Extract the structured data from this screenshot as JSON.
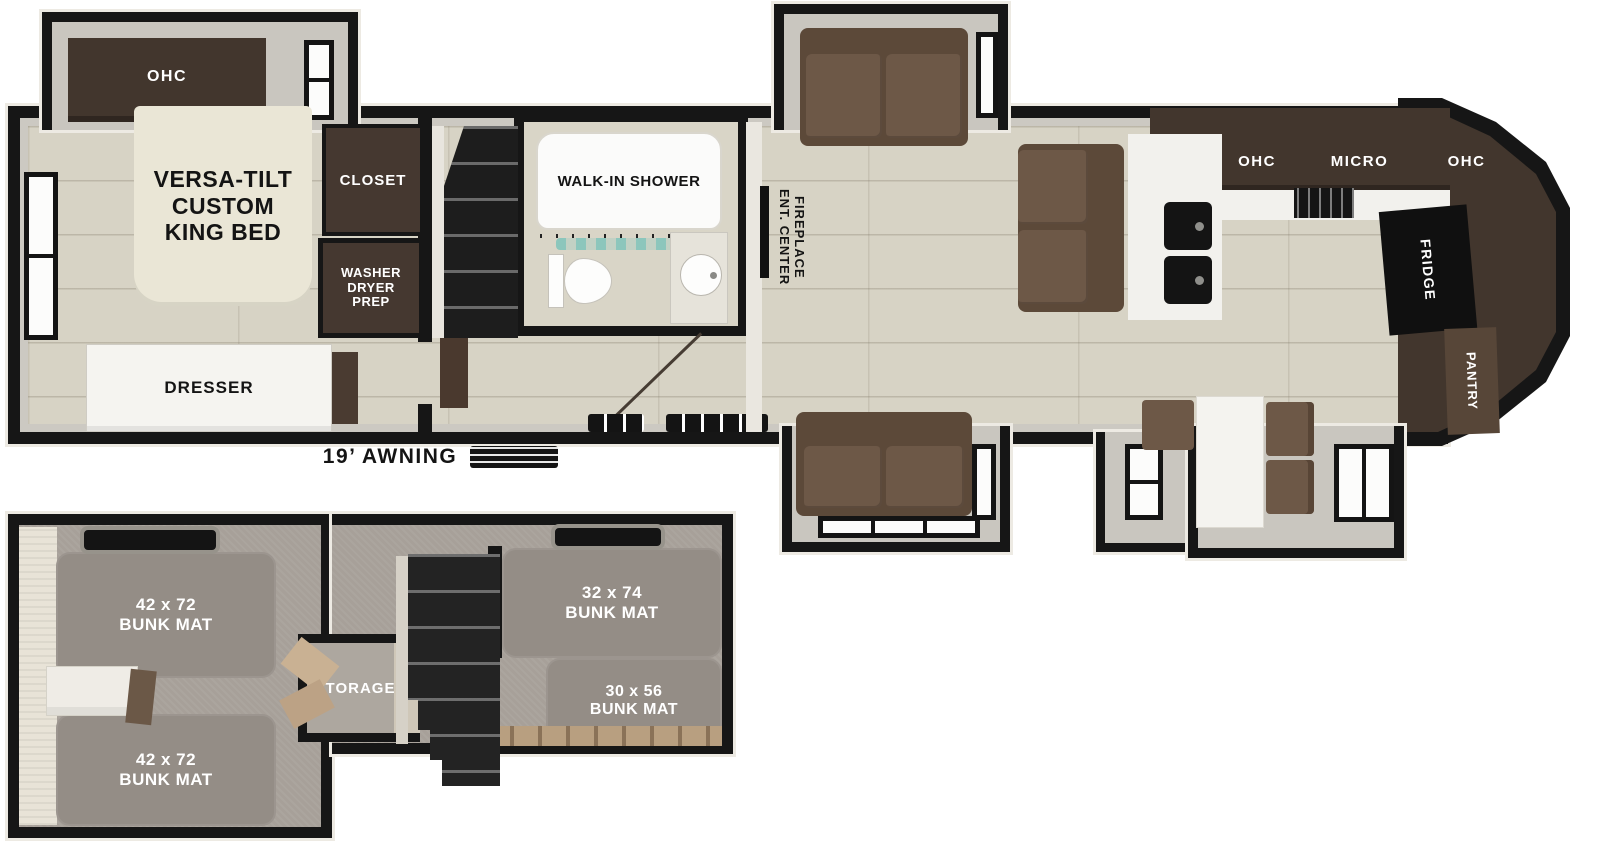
{
  "main_floor": {
    "bedroom": {
      "ohc": "OHC",
      "bed": "VERSA-TILT\nCUSTOM\nKING BED",
      "closet": "CLOSET",
      "washer": "WASHER\nDRYER\nPREP",
      "dresser": "DRESSER"
    },
    "awning": "19’ AWNING",
    "bathroom": {
      "shower": "WALK-IN SHOWER"
    },
    "living": {
      "fireplace": "ENT. CENTER\nFIREPLACE"
    },
    "kitchen": {
      "ohc_left": "OHC",
      "micro": "MICRO",
      "ohc_right": "OHC",
      "fridge": "FRIDGE",
      "pantry": "PANTRY"
    }
  },
  "lower_level": {
    "bunk_front_top": "42 x 72\nBUNK MAT",
    "bunk_front_bottom": "42 x 72\nBUNK MAT",
    "bunk_rear_top": "32 x 74\nBUNK MAT",
    "bunk_rear_bottom": "30 x 56\nBUNK MAT",
    "storage": "STORAGE"
  },
  "colors": {
    "wall_black": "#161616",
    "floor_wood": "#d7d3c5",
    "cabinet_brown": "#42362d",
    "sofa_brown": "#6d5847",
    "bed_cream": "#eae6d6",
    "carpet_gray": "#a7a099",
    "bunk_mat_gray": "#948d86",
    "curtain_teal": "#7ec4ba"
  }
}
